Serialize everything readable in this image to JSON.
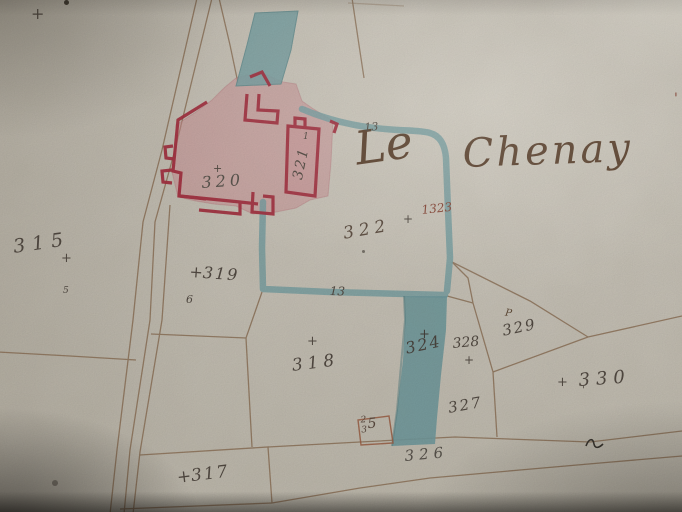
{
  "map": {
    "place_title": {
      "word1": "Le",
      "word2": "Chenay"
    },
    "parcels": {
      "p315": "315",
      "p317": "317",
      "p318": "318",
      "p319": "319",
      "p320": "320",
      "p321": "321",
      "p322": "322",
      "p1323": "1323",
      "p324": "324",
      "p325_digit_top": "2",
      "p325_digit_bottom": "3",
      "p325_digit_right": "5",
      "p326": "326",
      "p327": "327",
      "p328": "328",
      "p329": "329",
      "p330": "330"
    },
    "line_numbers": {
      "top": "13",
      "bottom": "13"
    },
    "marks": {
      "cross": "+",
      "six": "6",
      "flag": "P",
      "tick": "'",
      "tiny": "1"
    },
    "colors": {
      "paper": "#c9c4b8",
      "ink_brown": "#85664a",
      "ink_gray": "#4e463f",
      "ink_red": "#8a4636",
      "wash_blue": "#76a1a5",
      "wash_pink": "#cf8a92",
      "building_red": "#a52a3c",
      "title_ink": "#5a3f2b"
    }
  }
}
